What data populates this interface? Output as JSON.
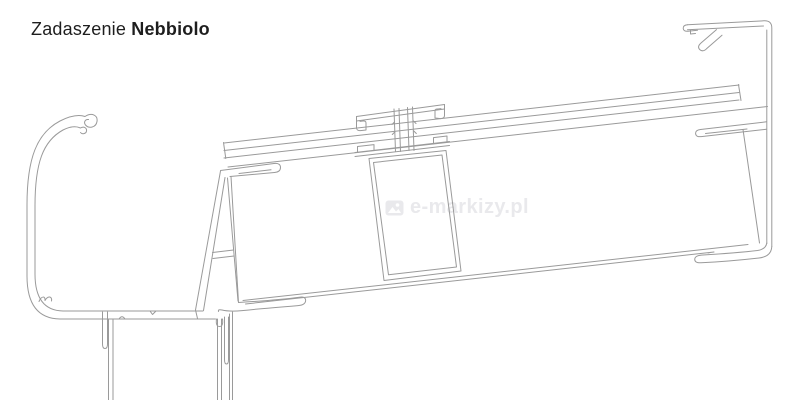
{
  "header": {
    "title_regular": "Zadaszenie",
    "title_bold": "Nebbiolo"
  },
  "watermark": {
    "text": "e-markizy.pl",
    "icon": "image-icon"
  },
  "colors": {
    "background": "#ffffff",
    "line": "#9a9a9a",
    "title": "#1e1e1e",
    "watermark": "#e9e9ec"
  }
}
